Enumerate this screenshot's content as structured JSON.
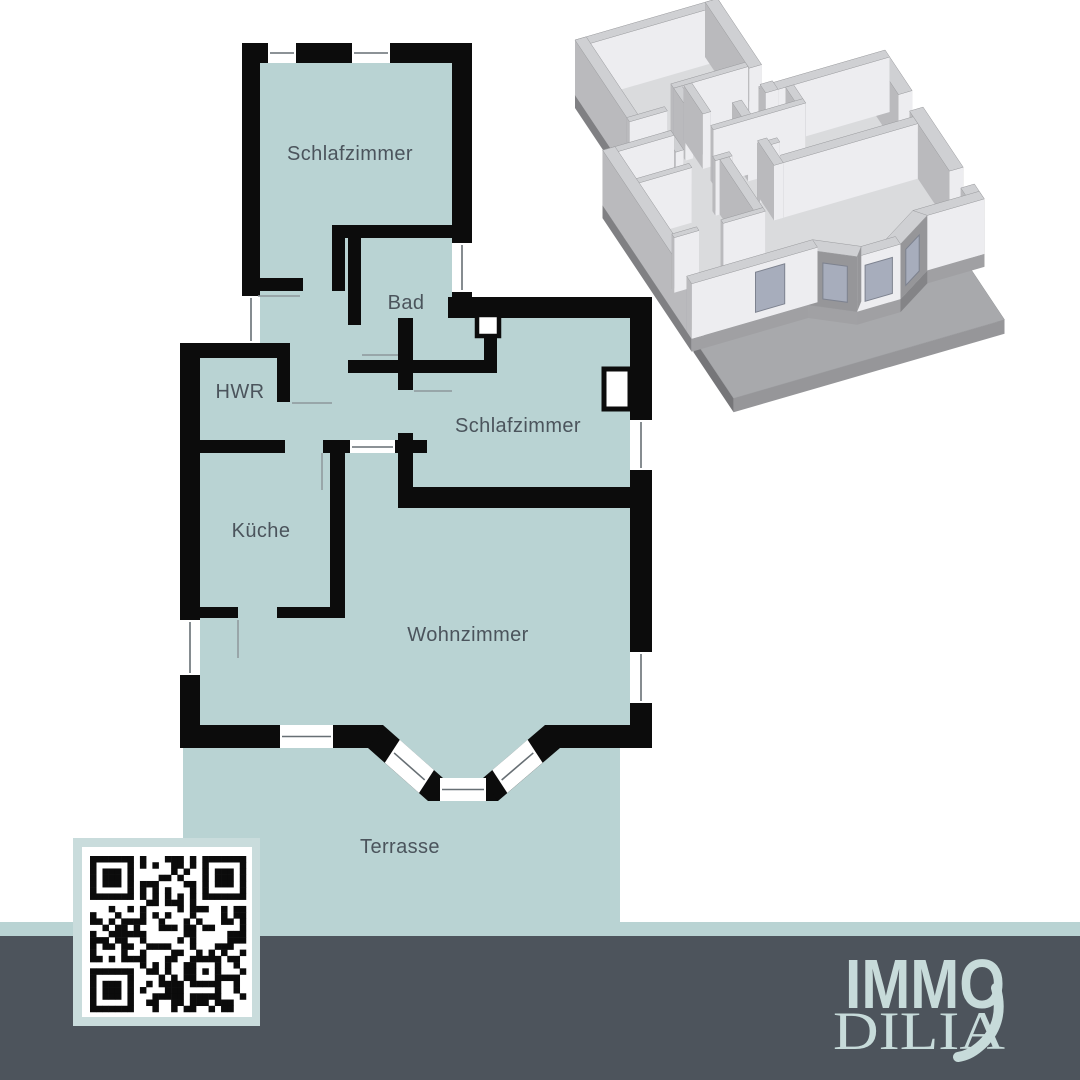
{
  "floor_plan": {
    "labels": {
      "bedroom1": "Schlafzimmer",
      "bathroom": "Bad",
      "utility": "HWR",
      "kitchen": "Küche",
      "bedroom2": "Schlafzimmer",
      "living_room": "Wohnzimmer",
      "terrace": "Terrasse"
    },
    "colors": {
      "room_fill": "#b9d3d3",
      "wall": "#0c0c0c",
      "label_text": "#4b545c",
      "opening_line": "#8e979b"
    }
  },
  "branding": {
    "logo_line1": "IMMO",
    "logo_line2": "DILIA",
    "logo_color": "#c7dbda",
    "banner_color": "#4d545c"
  },
  "qr_code": {
    "icon": "qr-code",
    "frame_color": "#c9dcdc"
  },
  "render_3d": {
    "icon": "house-3d-model",
    "wall_light": "#f0f0f2",
    "wall_dark": "#96979b",
    "slab_color": "#a8a9ac"
  }
}
